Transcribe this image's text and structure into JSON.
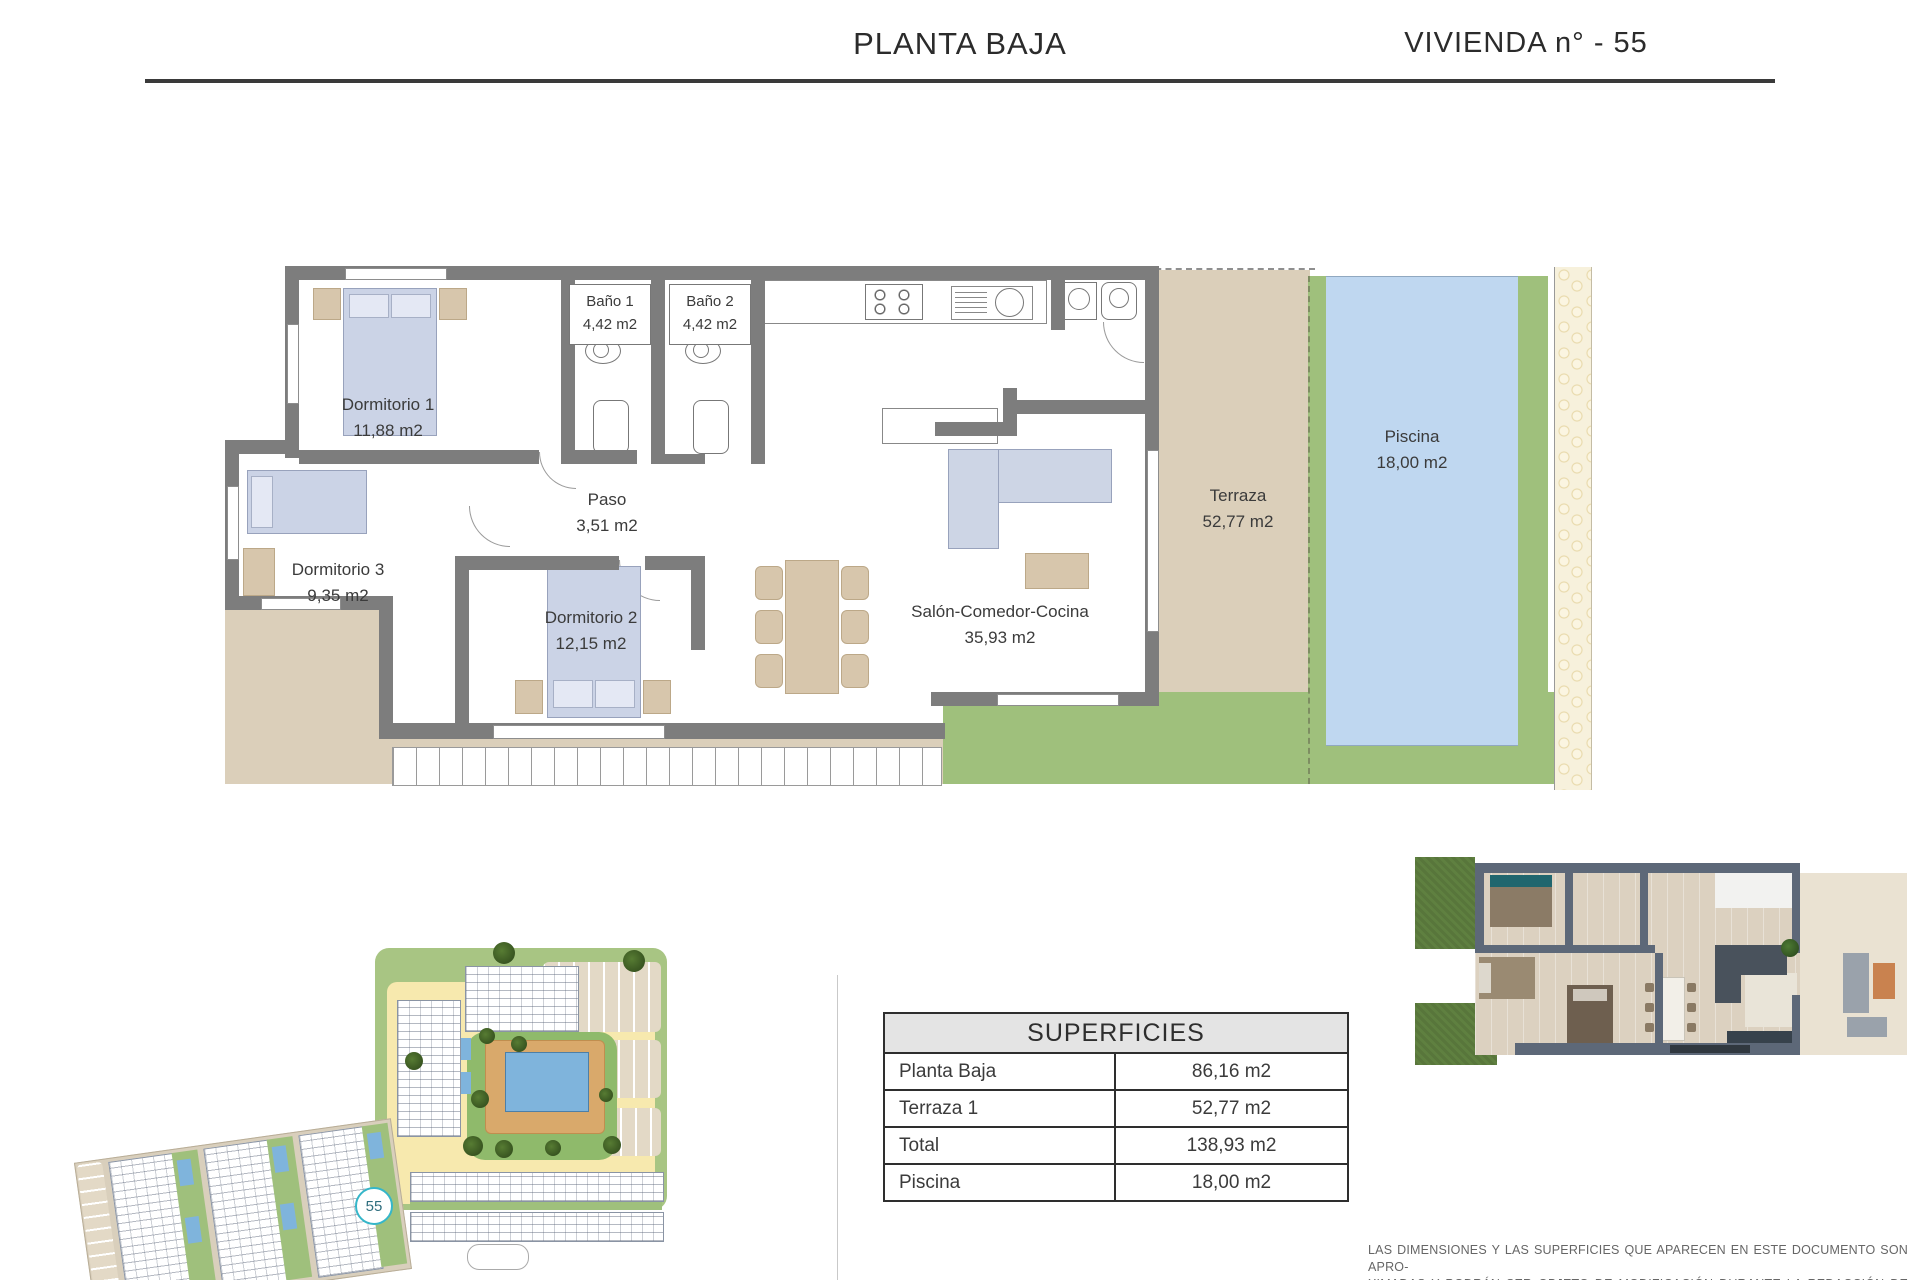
{
  "header": {
    "title": "PLANTA BAJA",
    "unit_label": "VIVIENDA n° - 55"
  },
  "floor_plan": {
    "rooms": [
      {
        "name": "Dormitorio 1",
        "area": "11,88 m2"
      },
      {
        "name": "Baño 1",
        "area": "4,42 m2"
      },
      {
        "name": "Baño 2",
        "area": "4,42 m2"
      },
      {
        "name": "Paso",
        "area": "3,51 m2"
      },
      {
        "name": "Dormitorio 3",
        "area": "9,35 m2"
      },
      {
        "name": "Dormitorio 2",
        "area": "12,15 m2"
      },
      {
        "name": "Salón-Comedor-Cocina",
        "area": "35,93 m2"
      },
      {
        "name": "Terraza",
        "area": "52,77 m2"
      },
      {
        "name": "Piscina",
        "area": "18,00 m2"
      }
    ]
  },
  "site_plan": {
    "unit_marker": "55"
  },
  "surfaces_table": {
    "title": "SUPERFICIES",
    "rows": [
      {
        "label": "Planta Baja",
        "value": "86,16 m2"
      },
      {
        "label": "Terraza 1",
        "value": "52,77 m2"
      },
      {
        "label": "Total",
        "value": "138,93 m2"
      },
      {
        "label": "Piscina",
        "value": "18,00 m2"
      }
    ]
  },
  "disclaimer": {
    "line1": "LAS DIMENSIONES Y LAS SUPERFICIES QUE APARECEN EN ESTE DOCUMENTO SON APRO-",
    "line2": "XIMADAS Y PODRÁN SER OBJETO DE MODIFICACIÓN DURANTE LA REDACCIÓN DE LOS",
    "line3": "PROYECTOS BÁSICO Y DE EJECUCIÓN."
  },
  "colors": {
    "wall_gray": "#7d7d7d",
    "terrace_tan": "#dbcfba",
    "pool_blue": "#bfd7f0",
    "lawn_green": "#9fc07c",
    "site_road_yellow": "#f7e9ae",
    "site_green": "#a8c583",
    "badge_accent": "#35b6c9",
    "bed_blue": "#cbd3e6",
    "furniture_tan": "#d7c6ac",
    "table_header_bg": "#e4e4e4",
    "text_dark": "#3b3b3b"
  }
}
